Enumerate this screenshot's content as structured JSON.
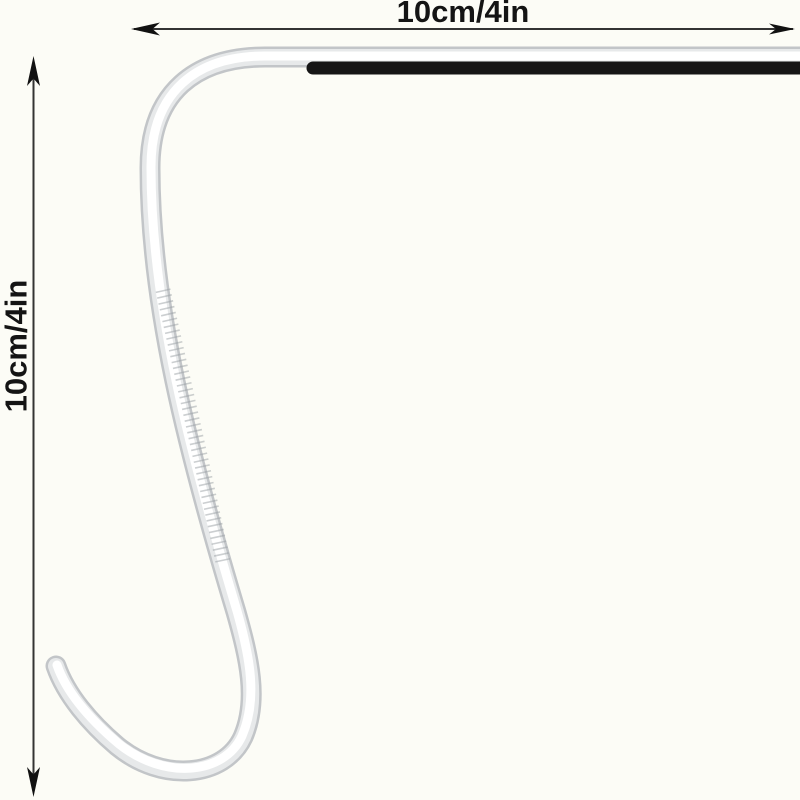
{
  "labels": {
    "width_dimension": "10cm/4in",
    "height_dimension": "10cm/4in"
  },
  "colors": {
    "background": "#fcfcf6",
    "rod_edge": "#c2c5c8",
    "rod_mid": "#e7e9ea",
    "rod_core": "#ffffff",
    "knurl_texture": "#9aa0a4",
    "sleeve": "#161616",
    "dimension_line": "#333333",
    "arrow": "#111111",
    "label_text": "#141414"
  }
}
